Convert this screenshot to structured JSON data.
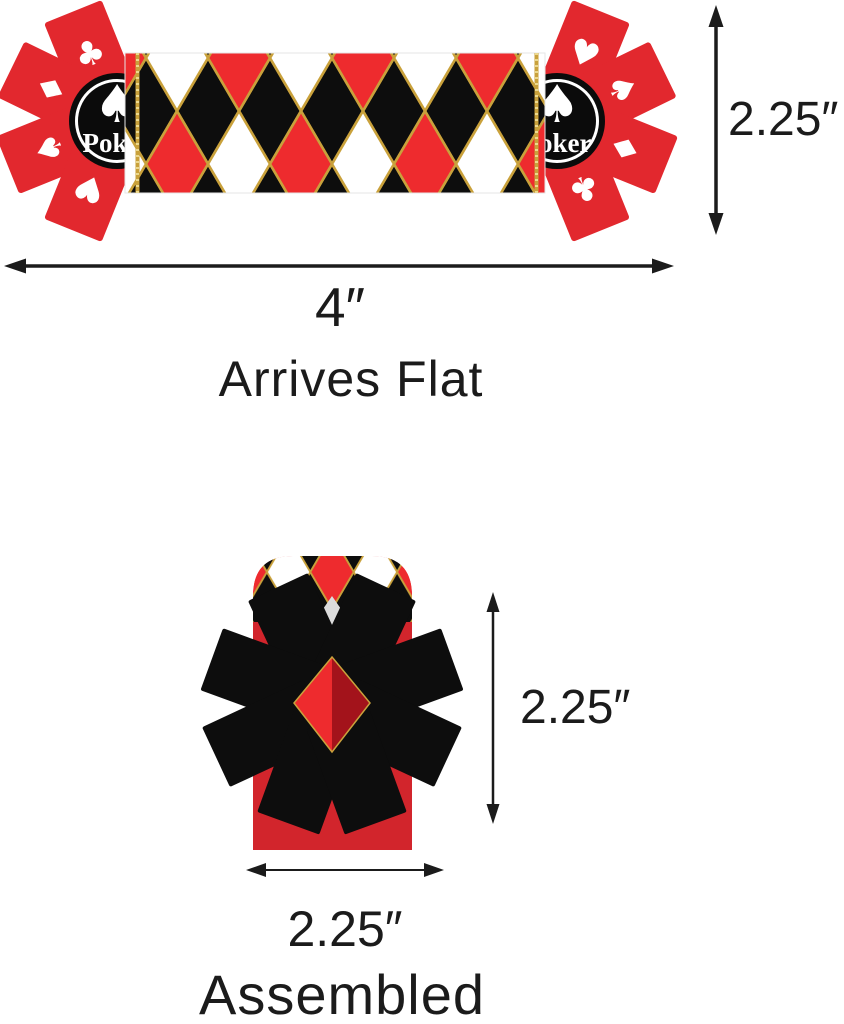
{
  "flat_view": {
    "caption": "Arrives Flat",
    "width_label": "4″",
    "height_label": "2.25″",
    "badge": {
      "label": "Poker"
    }
  },
  "assembled_view": {
    "caption": "Assembled",
    "width_label": "2.25″",
    "height_label": "2.25″"
  },
  "icons": {
    "spade": "♠",
    "heart": "♥",
    "diamond": "♦",
    "club": "♣"
  },
  "colors": {
    "flap_red": "#e2282e",
    "pattern_red": "#ee2b2e",
    "assembled_red": "#d2252c",
    "diamond_highlight_red": "#ee2b2e",
    "diamond_shadow_red": "#a3131b",
    "black": "#0d0d0d",
    "gold": "#c9a13b",
    "white": "#ffffff",
    "dimension_text": "#1b1b1b"
  }
}
